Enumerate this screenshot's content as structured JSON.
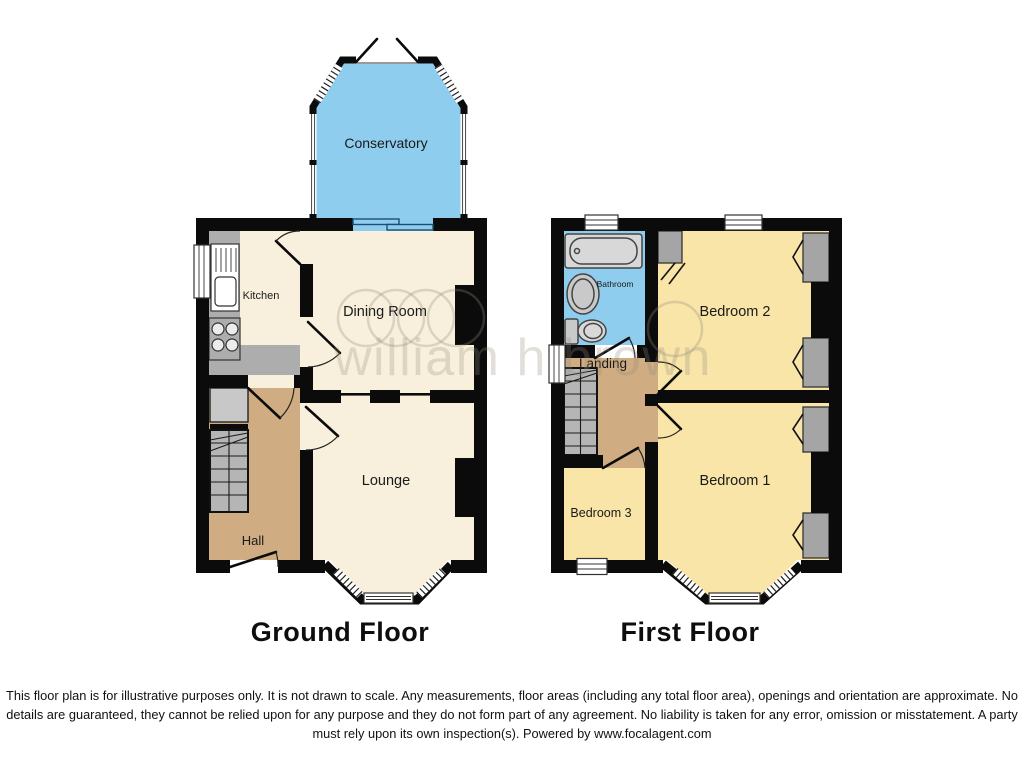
{
  "floorplan": {
    "ground_floor": {
      "title": "Ground Floor",
      "rooms": {
        "conservatory": "Conservatory",
        "kitchen": "Kitchen",
        "dining_room": "Dining Room",
        "lounge": "Lounge",
        "hall": "Hall"
      }
    },
    "first_floor": {
      "title": "First Floor",
      "rooms": {
        "bathroom": "Bathroom",
        "landing": "Landing",
        "bedroom2": "Bedroom 2",
        "bedroom1": "Bedroom 1",
        "bedroom3": "Bedroom 3"
      }
    },
    "watermark": "william h brown",
    "disclaimer_lines": [
      "This floor plan is for illustrative purposes only. It is not drawn to scale. Any measurements, floor areas (including any total floor area), openings and orientation are approximate. No",
      "details are guaranteed, they cannot be relied upon for any purpose and they do not form part of any agreement. No liability is taken for any error, omission or misstatement. A party",
      "must rely upon its own inspection(s). Powered by www.focalagent.com"
    ],
    "colors": {
      "wall": "#0b0b0b",
      "room_cream": "#F8F0DC",
      "room_yellow": "#F8E5A7",
      "room_blue": "#8FCDEF",
      "hall_tan": "#CFAC82",
      "counter_gray": "#ADADAD",
      "stairs_gray": "#B5B5B5",
      "cupboard_gray": "#C8C8C8",
      "wardrobe_gray": "#A5A5A5",
      "fixture_gray": "#D8D8D8",
      "window_white": "#FFFFFF",
      "slider_blue": "#8FCDEF"
    }
  }
}
